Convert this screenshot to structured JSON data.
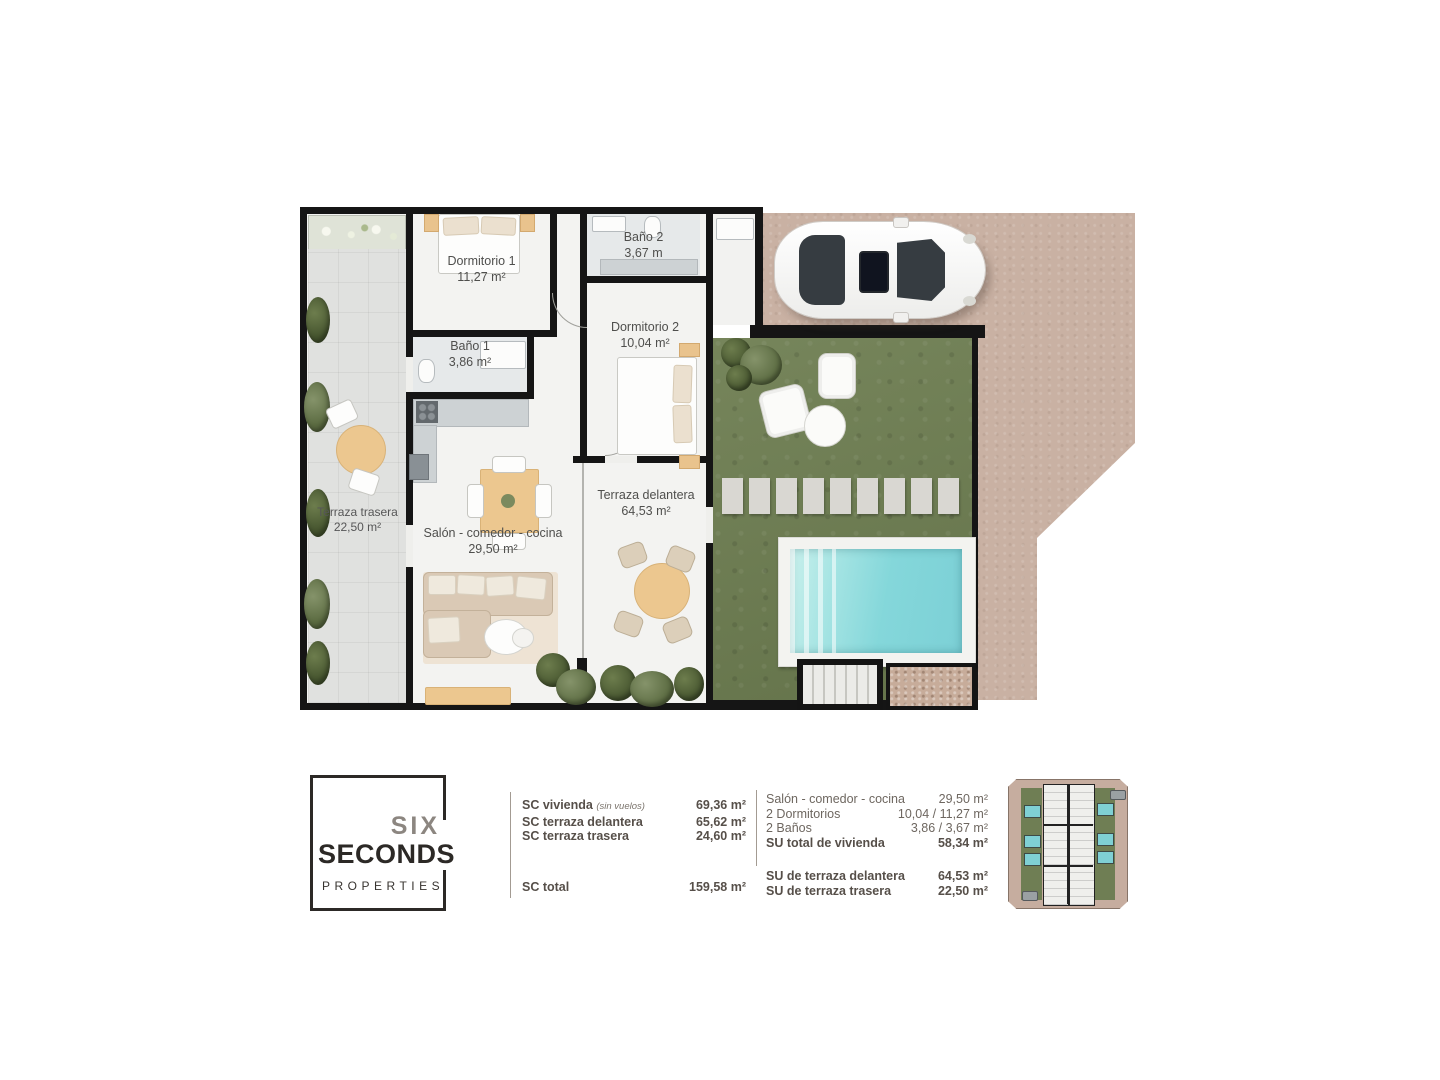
{
  "plan": {
    "dormitorio1": {
      "name": "Dormitorio 1",
      "area": "11,27 m²"
    },
    "bano2": {
      "name": "Baño 2",
      "area": "3,67 m"
    },
    "bano1": {
      "name": "Baño 1",
      "area": "3,86 m²"
    },
    "dormitorio2": {
      "name": "Dormitorio 2",
      "area": "10,04 m²"
    },
    "terraza_trasera": {
      "name": "Terraza trasera",
      "area": "22,50 m²"
    },
    "salon": {
      "name": "Salón - comedor - cocina",
      "area": "29,50 m²"
    },
    "terraza_delantera": {
      "name": "Terraza delantera",
      "area": "64,53 m²"
    }
  },
  "logo": {
    "six": "SIX",
    "seconds": "SECONDS",
    "properties": "PROPERTIES"
  },
  "areas_table": {
    "sc_rows": [
      {
        "label": "SC vivienda",
        "note": "(sin vuelos)",
        "value": "69,36 m²"
      },
      {
        "label": "SC terraza delantera",
        "note": "",
        "value": "65,62 m²"
      },
      {
        "label": "SC terraza trasera",
        "note": "",
        "value": "24,60 m²"
      }
    ],
    "sc_total": {
      "label": "SC total",
      "value": "159,58 m²"
    },
    "su_rows": [
      {
        "label": "Salón - comedor - cocina",
        "value": "29,50 m²"
      },
      {
        "label": "2 Dormitorios",
        "value": "10,04 / 11,27 m²"
      },
      {
        "label": "2 Baños",
        "value": "3,86 / 3,67 m²"
      },
      {
        "label": "SU total de vivienda",
        "value": "58,34 m²"
      }
    ],
    "su_extra": [
      {
        "label": "SU de terraza delantera",
        "value": "64,53 m²"
      },
      {
        "label": "SU de terraza trasera",
        "value": "22,50 m²"
      }
    ]
  },
  "colors": {
    "wall": "#151515",
    "paving": "#c9b1a3",
    "grass": "#6f7e52",
    "pool": "#7fd2d8",
    "logo_dark": "#2c2926",
    "logo_gray": "#8c8680",
    "table_text": "#564f49"
  }
}
